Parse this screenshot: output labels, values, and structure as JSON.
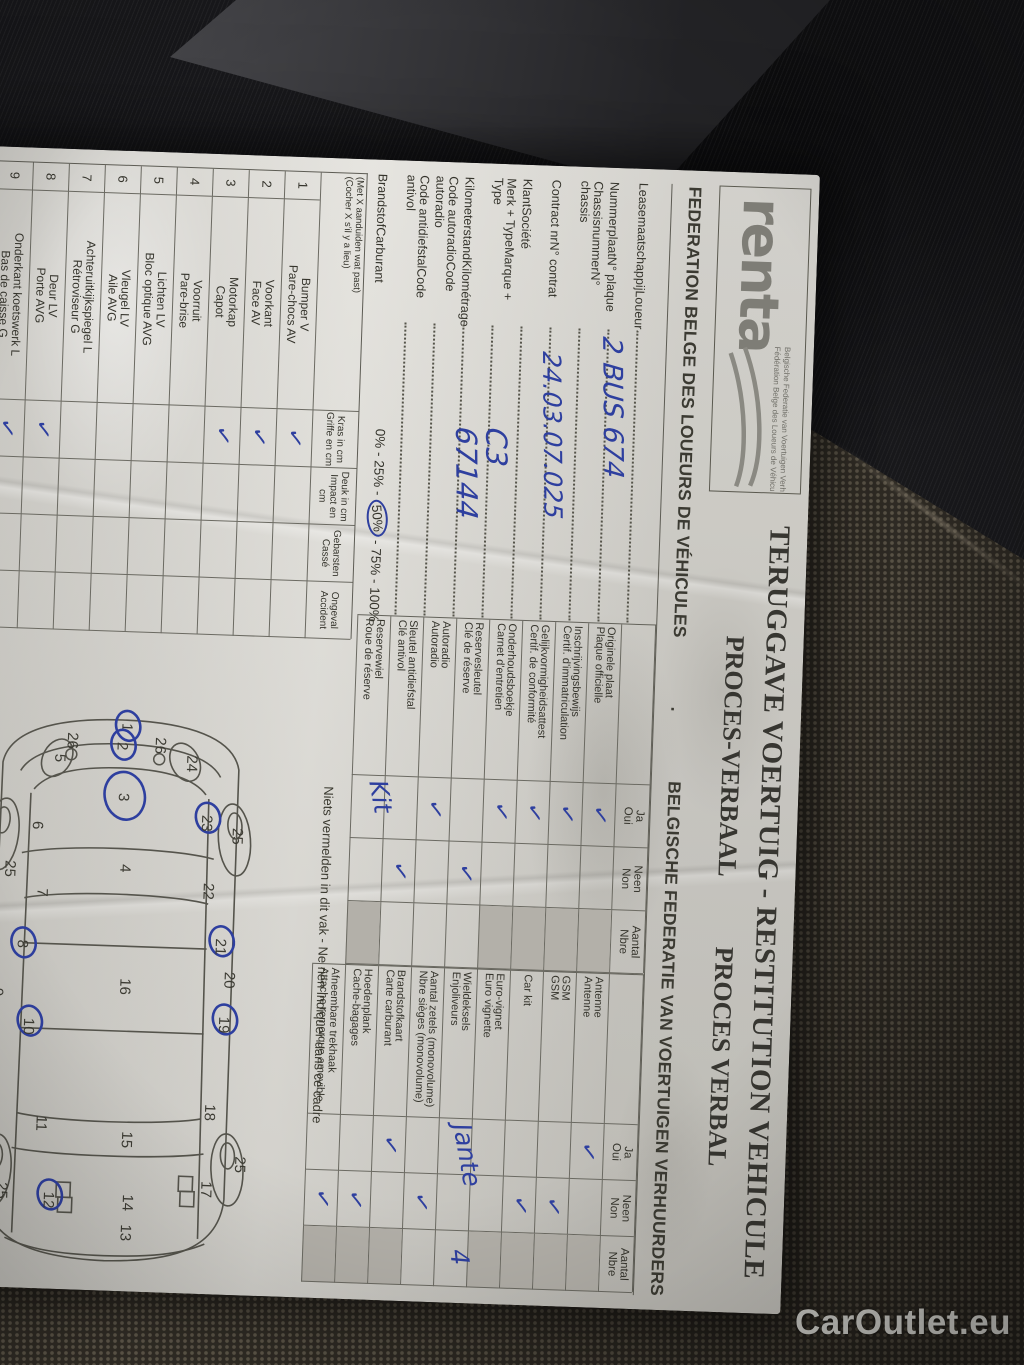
{
  "watermark": "CarOutlet.eu",
  "colors": {
    "pen": "#2e3f9f",
    "paper": "#dcdad3",
    "print": "#3b3a32",
    "cell_gray": "#b3b0a9",
    "seat_dark": "#18181b",
    "seat_mesh": "#39342c"
  },
  "header": {
    "logo_text": "renta",
    "logo_sub1": "Belgische Federatie van Voertuigen Verhuurders",
    "logo_sub2": "Fédération Belge des Loueurs de Véhicules",
    "title_line1": "TERUGGAVE VOERTUIG - RESTITUTION VEHICULE",
    "title_line2_nl": "PROCES-VERBAAL",
    "title_line2_fr": "PROCES VERBAL",
    "federation_fr": "FEDERATION BELGE DES LOUEURS DE VÉHICULES",
    "federation_sep": ".",
    "federation_nl": "BELGISCHE FEDERATIE VAN VOERTUIGEN VERHUURDERS"
  },
  "fields": [
    {
      "nl": "Leasemaatschappij",
      "fr": "Loueur",
      "value": ""
    },
    {
      "nl": "Nummerplaat",
      "fr": "N° plaque",
      "value": "2 BUS 674"
    },
    {
      "nl": "Chassisnummer",
      "fr": "N° chassis",
      "value": ""
    },
    {
      "nl": "Contract nr",
      "fr": "N° contrat",
      "value": "24.03.07.025"
    },
    {
      "nl": "Klant",
      "fr": "Société",
      "value": ""
    },
    {
      "nl": "Merk + Type",
      "fr": "Marque + Type",
      "value": "C3"
    },
    {
      "nl": "Kilometerstand",
      "fr": "Kilométrage",
      "value": "67144"
    },
    {
      "nl": "Code autoradio",
      "fr": "Code autoradio",
      "value": ""
    },
    {
      "nl": "Code antidiefstal",
      "fr": "Code antivol",
      "value": ""
    },
    {
      "nl": "Brandstof",
      "fr": "Carburant",
      "value": "0% - 25% - 50% - 75% - 100%",
      "circled": "50%"
    }
  ],
  "check_cols": {
    "ja_nl": "Ja",
    "ja_fr": "Oui",
    "neen_nl": "Neen",
    "neen_fr": "Non",
    "aantal_nl": "Aantal",
    "aantal_fr": "Nbre"
  },
  "documents_table": [
    {
      "nl": "Originele plaat",
      "fr": "Plaque officielle",
      "ja": true,
      "gray": true
    },
    {
      "nl": "Inschrijvingsbewijs",
      "fr": "Certif. d'immatriculation",
      "ja": true,
      "gray": true
    },
    {
      "nl": "Gelijkvormigheidsattest",
      "fr": "Certif. de conformité",
      "ja": true,
      "gray": true
    },
    {
      "nl": "Onderhoudsboekje",
      "fr": "Carnet d'entretien",
      "ja": true,
      "gray": true
    },
    {
      "nl": "Reservesleutel",
      "fr": "Clé de réserve",
      "neen": true,
      "gray": false
    },
    {
      "nl": "Autoradio",
      "fr": "Autoradio",
      "ja": true,
      "gray": false
    },
    {
      "nl": "Sleutel antidiefstal",
      "fr": "Clé antivol",
      "neen": true,
      "gray": false
    },
    {
      "nl": "Reservewiel",
      "fr": "Roue de réserve",
      "hand": "Kit",
      "gray": true
    }
  ],
  "accessories_table": [
    {
      "nl": "Antenne",
      "fr": "Antenne",
      "ja": true,
      "gray": true
    },
    {
      "nl": "GSM",
      "fr": "GSM",
      "neen": true,
      "gray": true
    },
    {
      "nl": "Car kit",
      "fr": "",
      "neen": true,
      "gray": true
    },
    {
      "nl": "Euro-vignet",
      "fr": "Euro vignette",
      "gray": true
    },
    {
      "nl": "Wieldeksels",
      "fr": "Enjoliveurs",
      "hand": "Jante",
      "aantal_hand": "4",
      "gray": false
    },
    {
      "nl": "Aantal zetels (monovolume)",
      "fr": "Nbre sièges (monovolume)",
      "neen": true,
      "gray": false
    },
    {
      "nl": "Brandstofkaart",
      "fr": "Carte carburant",
      "ja": true,
      "gray": true
    },
    {
      "nl": "Hoedenplank",
      "fr": "Cache-bagages",
      "neen": true,
      "gray": true
    },
    {
      "nl": "Afneembare trekhaak",
      "fr": "Attache remorque amovible",
      "neen": true,
      "gray": true
    }
  ],
  "damage_table": {
    "note_nl": "(Met X aanduiden wat past)",
    "note_fr": "(Cocher X s'il y a lieu)",
    "columns": [
      {
        "nl": "Kras in cm",
        "fr": "Griffe en cm"
      },
      {
        "nl": "Deuk in cm",
        "fr": "Impact en cm"
      },
      {
        "nl": "Gebarsten",
        "fr": "Cassé"
      },
      {
        "nl": "Ongeval",
        "fr": "Accident"
      }
    ],
    "rows": [
      {
        "num": "1",
        "nl": "Bumper V",
        "fr": "Pare-chocs AV",
        "kras": true
      },
      {
        "num": "2",
        "nl": "Voorkant",
        "fr": "Face AV",
        "kras": true
      },
      {
        "num": "3",
        "nl": "Motorkap",
        "fr": "Capot",
        "kras": true
      },
      {
        "num": "4",
        "nl": "Voorruit",
        "fr": "Pare-brise"
      },
      {
        "num": "5",
        "nl": "Lichten LV",
        "fr": "Bloc optique AVG"
      },
      {
        "num": "6",
        "nl": "Vleugel LV",
        "fr": "Aile AVG"
      },
      {
        "num": "7",
        "nl": "Achteruitkijkspiegel L",
        "fr": "Rétroviseur G"
      },
      {
        "num": "8",
        "nl": "Deur LV",
        "fr": "Porte AVG",
        "kras": true
      },
      {
        "num": "9",
        "nl": "Onderkant koetswerk L",
        "fr": "Bas de caisse G",
        "kras": true
      },
      {
        "num": "",
        "nl": "",
        "fr": ""
      }
    ]
  },
  "no_write_note": "Niets vermelden in dit vak  -  Ne rien indiquer dans ce cadre",
  "car_diagram": {
    "zones": [
      {
        "n": "1",
        "x": 27,
        "y": 196,
        "c": true
      },
      {
        "n": "2",
        "x": 46,
        "y": 200,
        "c": true
      },
      {
        "n": "26",
        "x": 40,
        "y": 162,
        "dot": true
      },
      {
        "n": "26",
        "x": 38,
        "y": 250,
        "dot": true
      },
      {
        "n": "24",
        "x": 57,
        "y": 130
      },
      {
        "n": "5",
        "x": 60,
        "y": 262
      },
      {
        "n": "3",
        "x": 97,
        "y": 197,
        "c": true
      },
      {
        "n": "23",
        "x": 116,
        "y": 113,
        "c": true
      },
      {
        "n": "6",
        "x": 128,
        "y": 282
      },
      {
        "n": "4",
        "x": 168,
        "y": 193
      },
      {
        "n": "22",
        "x": 184,
        "y": 109
      },
      {
        "n": "7",
        "x": 195,
        "y": 275
      },
      {
        "n": "21",
        "x": 239,
        "y": 95,
        "c": true
      },
      {
        "n": "8",
        "x": 247,
        "y": 293,
        "c": true
      },
      {
        "n": "20",
        "x": 272,
        "y": 85
      },
      {
        "n": "16",
        "x": 282,
        "y": 189
      },
      {
        "n": "9",
        "x": 296,
        "y": 316
      },
      {
        "n": "19",
        "x": 317,
        "y": 89,
        "c": true
      },
      {
        "n": "10",
        "x": 325,
        "y": 284,
        "c": true
      },
      {
        "n": "18",
        "x": 405,
        "y": 100
      },
      {
        "n": "11",
        "x": 422,
        "y": 268
      },
      {
        "n": "15",
        "x": 435,
        "y": 182
      },
      {
        "n": "17",
        "x": 482,
        "y": 101
      },
      {
        "n": "12",
        "x": 498,
        "y": 258,
        "c": true
      },
      {
        "n": "14",
        "x": 498,
        "y": 179
      },
      {
        "n": "13",
        "x": 528,
        "y": 180
      },
      {
        "n": "25",
        "x": 128,
        "y": 82
      },
      {
        "n": "25",
        "x": 168,
        "y": 308
      },
      {
        "n": "25",
        "x": 456,
        "y": 68
      },
      {
        "n": "25",
        "x": 490,
        "y": 305
      }
    ]
  }
}
